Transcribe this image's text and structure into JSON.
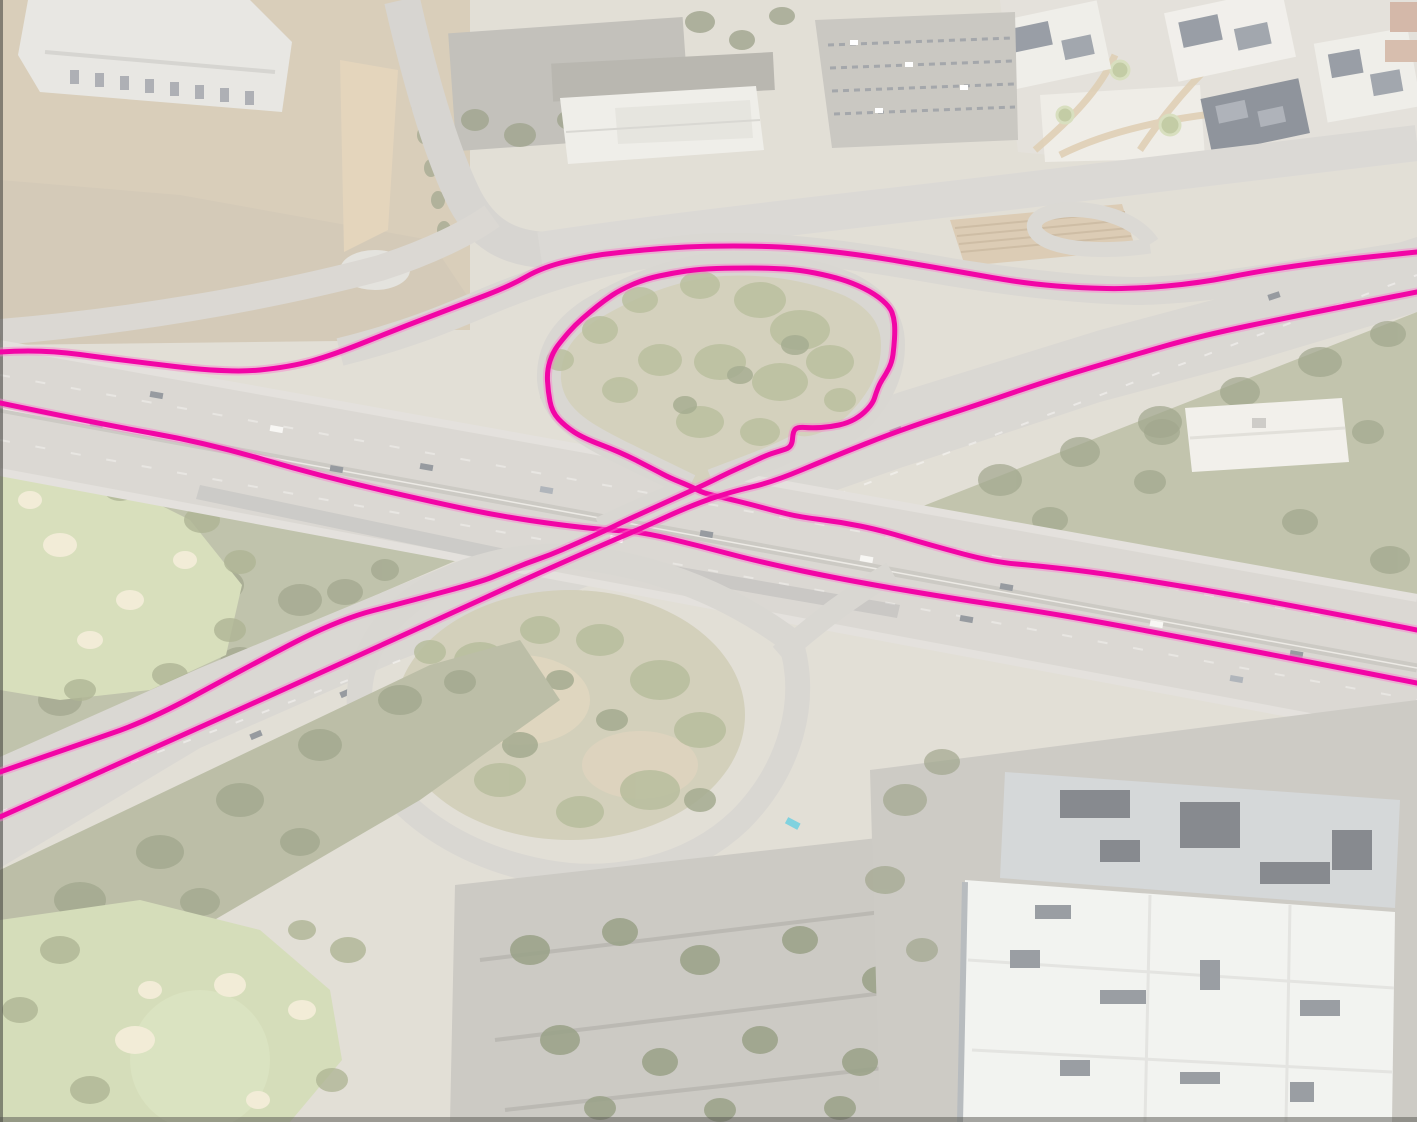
{
  "app": {
    "view": "aerial-imagery-with-road-overlay",
    "description": "Oblique aerial photo of a freeway interchange with magenta route geometry overlay"
  },
  "overlay": {
    "trace_color": "#f205a6",
    "trace_halo_color": "#fb7fce",
    "trace_width": 5,
    "halo_width": 9,
    "traces": [
      {
        "id": "north-ramp-trace",
        "points": [
          [
            0,
            352
          ],
          [
            40,
            349
          ],
          [
            120,
            360
          ],
          [
            230,
            373
          ],
          [
            290,
            367
          ],
          [
            333,
            355
          ],
          [
            400,
            328
          ],
          [
            463,
            304
          ],
          [
            510,
            286
          ],
          [
            543,
            267
          ],
          [
            590,
            256
          ],
          [
            623,
            252
          ],
          [
            665,
            248
          ],
          [
            707,
            246
          ],
          [
            760,
            246
          ],
          [
            800,
            248
          ],
          [
            845,
            253
          ],
          [
            880,
            258
          ],
          [
            915,
            264
          ],
          [
            950,
            270
          ],
          [
            1000,
            279
          ],
          [
            1033,
            284
          ],
          [
            1080,
            288
          ],
          [
            1133,
            289
          ],
          [
            1200,
            283
          ],
          [
            1260,
            271
          ],
          [
            1330,
            261
          ],
          [
            1417,
            252
          ]
        ]
      },
      {
        "id": "south-freeway-trace",
        "points": [
          [
            0,
            403
          ],
          [
            100,
            424
          ],
          [
            207,
            443
          ],
          [
            320,
            476
          ],
          [
            437,
            503
          ],
          [
            500,
            516
          ],
          [
            560,
            525
          ],
          [
            607,
            530
          ],
          [
            642,
            532
          ],
          [
            700,
            546
          ],
          [
            760,
            562
          ],
          [
            845,
            580
          ],
          [
            950,
            598
          ],
          [
            1030,
            610
          ],
          [
            1100,
            622
          ],
          [
            1200,
            641
          ],
          [
            1300,
            660
          ],
          [
            1417,
            683
          ]
        ]
      },
      {
        "id": "loop-ramp-trace",
        "points": [
          [
            1417,
            630
          ],
          [
            1300,
            607
          ],
          [
            1200,
            589
          ],
          [
            1100,
            573
          ],
          [
            1040,
            566
          ],
          [
            993,
            562
          ],
          [
            930,
            545
          ],
          [
            880,
            530
          ],
          [
            840,
            522
          ],
          [
            800,
            517
          ],
          [
            775,
            511
          ],
          [
            753,
            505
          ],
          [
            725,
            498
          ],
          [
            703,
            493
          ],
          [
            690,
            486
          ],
          [
            670,
            478
          ],
          [
            655,
            470
          ],
          [
            620,
            452
          ],
          [
            583,
            438
          ],
          [
            565,
            426
          ],
          [
            552,
            412
          ],
          [
            548,
            391
          ],
          [
            547,
            370
          ],
          [
            553,
            352
          ],
          [
            562,
            340
          ],
          [
            575,
            325
          ],
          [
            590,
            312
          ],
          [
            605,
            300
          ],
          [
            620,
            290
          ],
          [
            645,
            279
          ],
          [
            673,
            273
          ],
          [
            700,
            269
          ],
          [
            733,
            268
          ],
          [
            770,
            268
          ],
          [
            800,
            270
          ],
          [
            830,
            276
          ],
          [
            853,
            283
          ],
          [
            875,
            294
          ],
          [
            890,
            307
          ],
          [
            894,
            318
          ],
          [
            895,
            330
          ],
          [
            894,
            347
          ],
          [
            892,
            362
          ],
          [
            886,
            374
          ],
          [
            880,
            383
          ],
          [
            876,
            393
          ],
          [
            873,
            403
          ],
          [
            862,
            415
          ],
          [
            848,
            423
          ],
          [
            830,
            427
          ],
          [
            812,
            428
          ],
          [
            798,
            427
          ],
          [
            793,
            431
          ],
          [
            792,
            447
          ],
          [
            780,
            451
          ],
          [
            767,
            455
          ],
          [
            748,
            464
          ],
          [
            730,
            472
          ],
          [
            712,
            481
          ],
          [
            695,
            489
          ],
          [
            660,
            505
          ],
          [
            627,
            520
          ],
          [
            600,
            533
          ],
          [
            573,
            545
          ],
          [
            550,
            555
          ],
          [
            527,
            563
          ],
          [
            503,
            573
          ],
          [
            480,
            582
          ],
          [
            410,
            601
          ],
          [
            337,
            620
          ],
          [
            240,
            671
          ],
          [
            150,
            720
          ],
          [
            75,
            746
          ],
          [
            0,
            772
          ]
        ]
      },
      {
        "id": "northeast-diagonal-trace",
        "points": [
          [
            0,
            817
          ],
          [
            150,
            750
          ],
          [
            300,
            682
          ],
          [
            437,
            620
          ],
          [
            530,
            577
          ],
          [
            600,
            546
          ],
          [
            642,
            528
          ],
          [
            690,
            506
          ],
          [
            730,
            492
          ],
          [
            773,
            482
          ],
          [
            830,
            458
          ],
          [
            900,
            430
          ],
          [
            980,
            404
          ],
          [
            1050,
            380
          ],
          [
            1130,
            356
          ],
          [
            1200,
            336
          ],
          [
            1300,
            315
          ],
          [
            1417,
            292
          ]
        ]
      }
    ]
  },
  "scene_palette": {
    "base": "#ddd8cd",
    "freeway": "#ccc8c1",
    "secondary_road": "#cbc7c0",
    "golf_green": "#c7d2a0",
    "sand": "#ece4c6",
    "hill": "#c2bea1",
    "tree": "#8d9668",
    "building_white": "#edeeea",
    "wash_opacity": 0.3
  }
}
